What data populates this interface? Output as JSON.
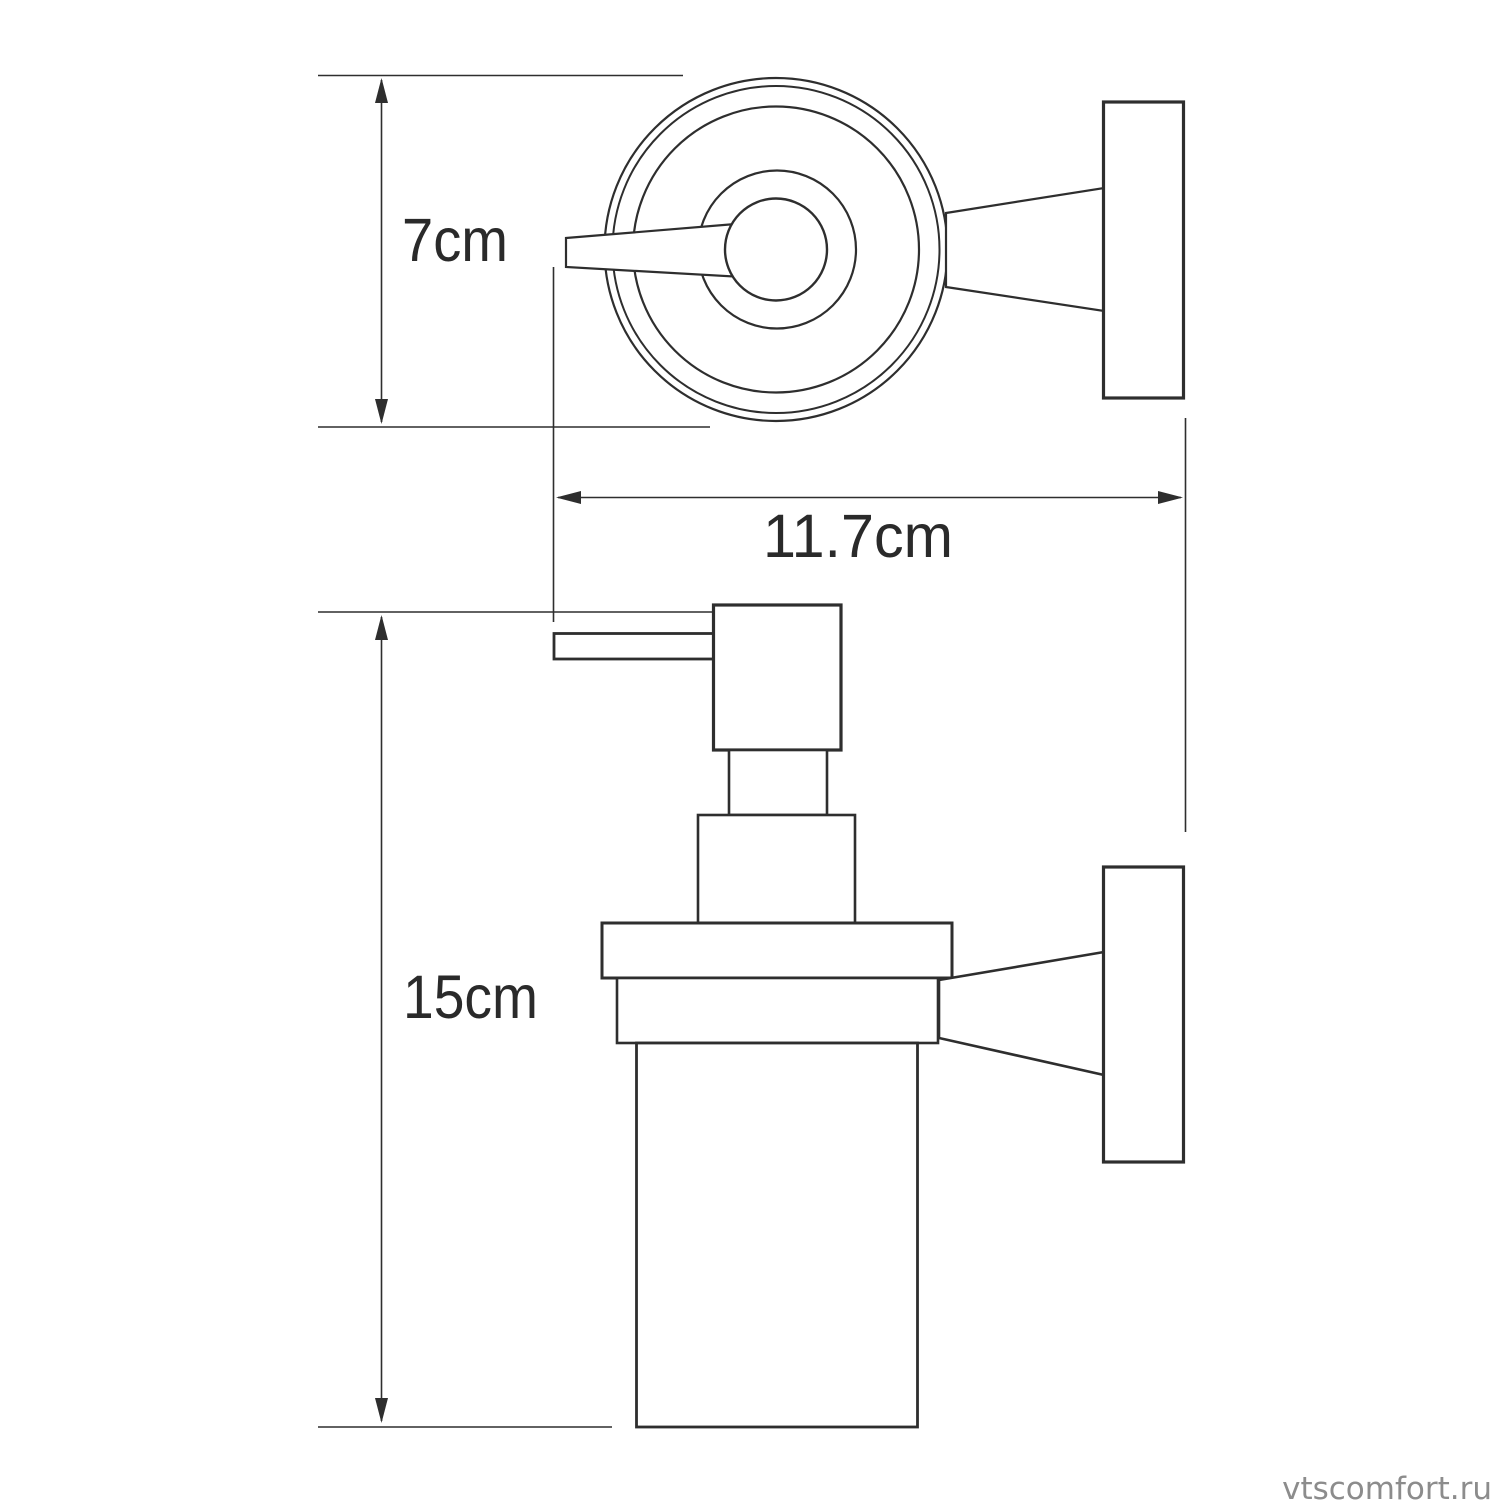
{
  "page": {
    "background_color": "#ffffff"
  },
  "drawing": {
    "subject": "wall-mounted glass soap dispenser technical drawing",
    "views": [
      "top view with wall mount",
      "side view with wall mount"
    ],
    "line_color": "#2e2e2e"
  },
  "dimensions": {
    "holder_diameter": {
      "label": "7cm"
    },
    "depth": {
      "label": "11.7cm"
    },
    "height": {
      "label": "15cm"
    }
  },
  "watermark": {
    "text": "vtscomfort.ru",
    "color": "#8c8c8c"
  }
}
